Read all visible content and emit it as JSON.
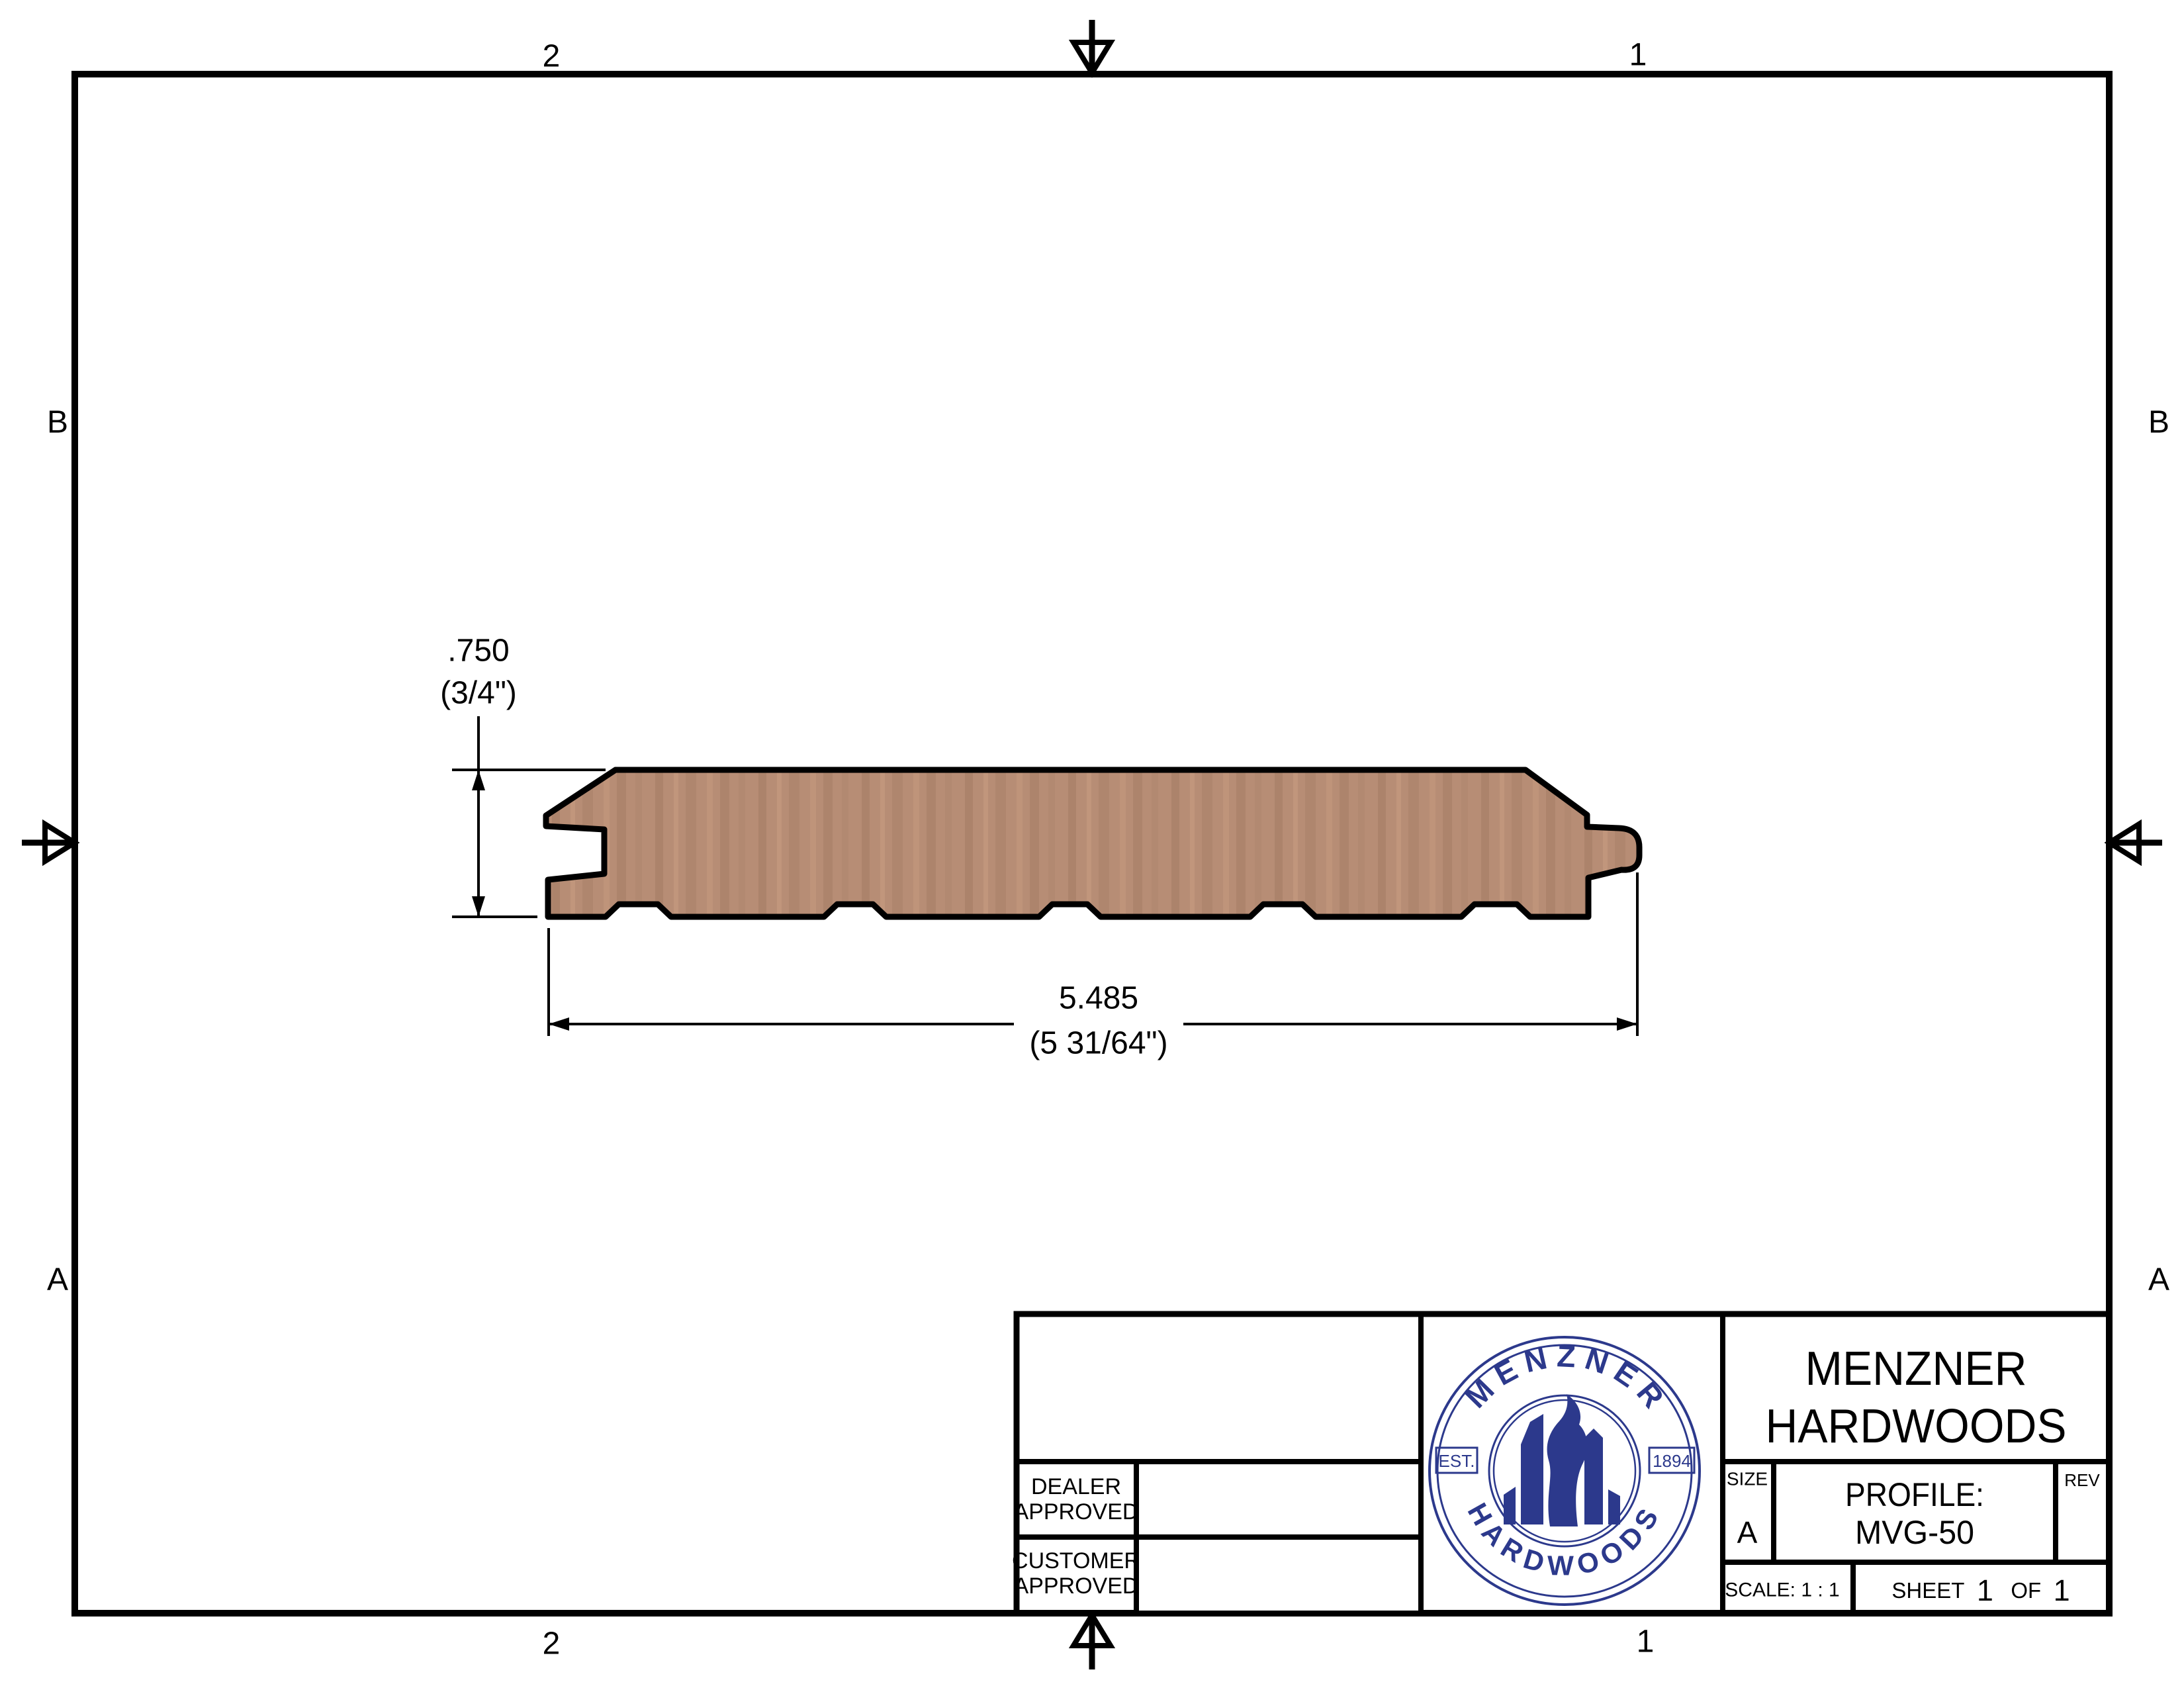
{
  "sheet": {
    "zones": {
      "top_left": "2",
      "top_right": "1",
      "bottom_left": "2",
      "bottom_right": "1",
      "left_upper": "B",
      "left_lower": "A",
      "right_upper": "B",
      "right_lower": "A"
    }
  },
  "drawing": {
    "thickness": {
      "decimal": ".750",
      "fraction": "(3/4\")"
    },
    "width": {
      "decimal": "5.485",
      "fraction": "(5 31/64\")"
    }
  },
  "title_block": {
    "dealer": {
      "line1": "DEALER",
      "line2": "APPROVED"
    },
    "customer": {
      "line1": "CUSTOMER",
      "line2": "APPROVED"
    },
    "company": {
      "line1": "MENZNER",
      "line2": "HARDWOODS"
    },
    "size": {
      "label": "SIZE",
      "value": "A"
    },
    "profile": {
      "label": "PROFILE:",
      "value": "MVG-50"
    },
    "rev_label": "REV",
    "scale_text": "SCALE: 1 : 1",
    "sheet_row": {
      "label": "SHEET",
      "number": "1",
      "of": "OF",
      "total": "1"
    }
  },
  "logo": {
    "arc_top": "MENZNER",
    "arc_bottom": "HARDWOODS",
    "est": "EST.",
    "year": "1894"
  },
  "colors": {
    "logo_navy": "#2c398c",
    "wood_base": "#b78d75",
    "wood_dark": "#9a735c",
    "wood_light": "#c89c80",
    "ink": "#000000"
  }
}
